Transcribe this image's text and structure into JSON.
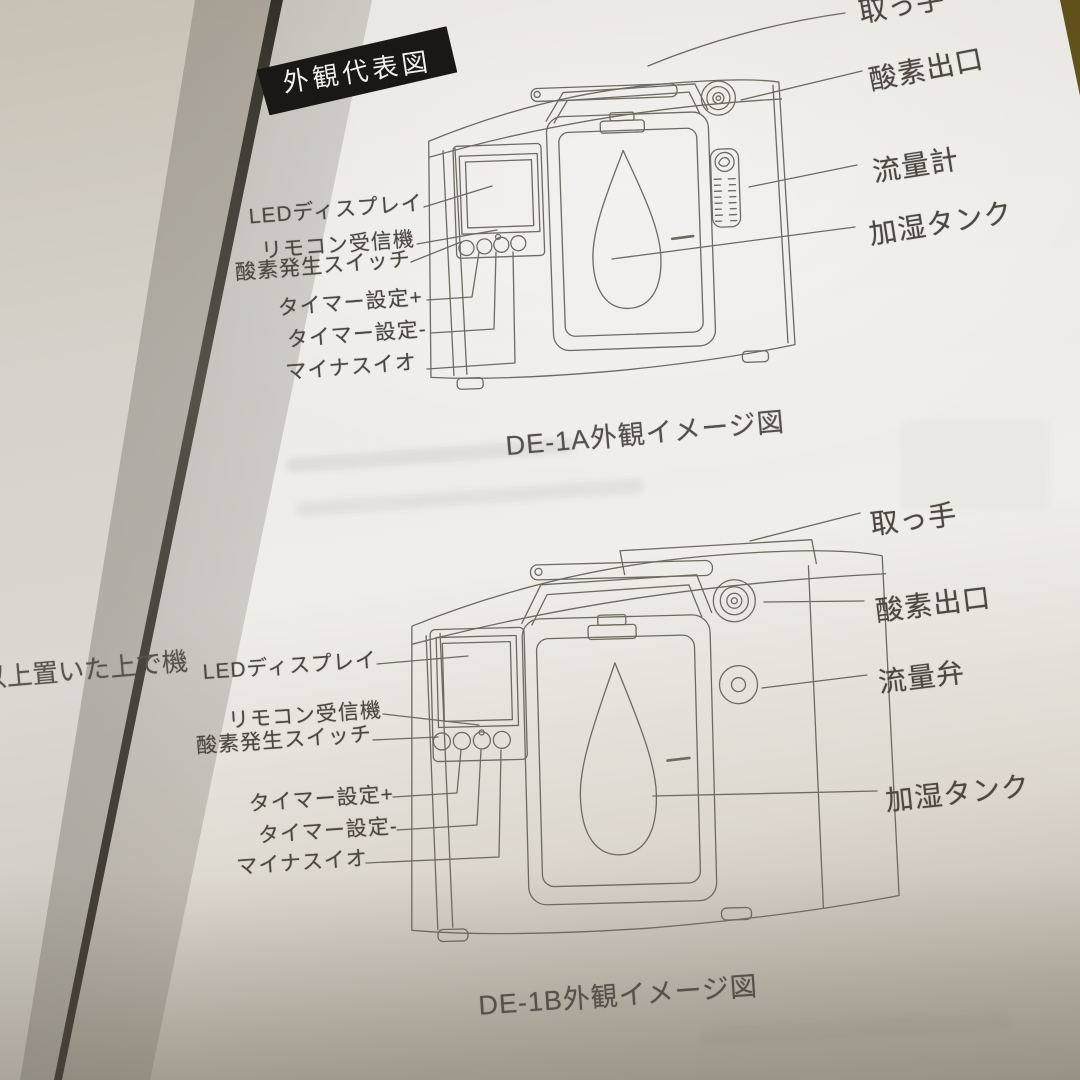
{
  "page": {
    "badge": "外観代表図",
    "left_page_fragment": "以上置いた上で機"
  },
  "diagram_a": {
    "caption": "DE-1A外観イメージ図",
    "labels_right": [
      "取っ手",
      "酸素出口",
      "流量計",
      "加湿タンク"
    ],
    "labels_left": [
      "LEDディスプレイ",
      "リモコン受信機",
      "酸素発生スイッチ",
      "タイマー設定+",
      "タイマー設定-",
      "マイナスイオ"
    ]
  },
  "diagram_b": {
    "caption": "DE-1B外観イメージ図",
    "labels_right": [
      "取っ手",
      "酸素出口",
      "流量弁",
      "加湿タンク"
    ],
    "labels_left": [
      "LEDディスプレイ",
      "リモコン受信機",
      "酸素発生スイッチ",
      "タイマー設定+",
      "タイマー設定-",
      "マイナスイオ"
    ]
  },
  "colors": {
    "paper": "#efeeea",
    "ink": "#4c473f",
    "line": "#6e6a61",
    "badge_bg": "#191815",
    "table": "#6b5a22"
  }
}
